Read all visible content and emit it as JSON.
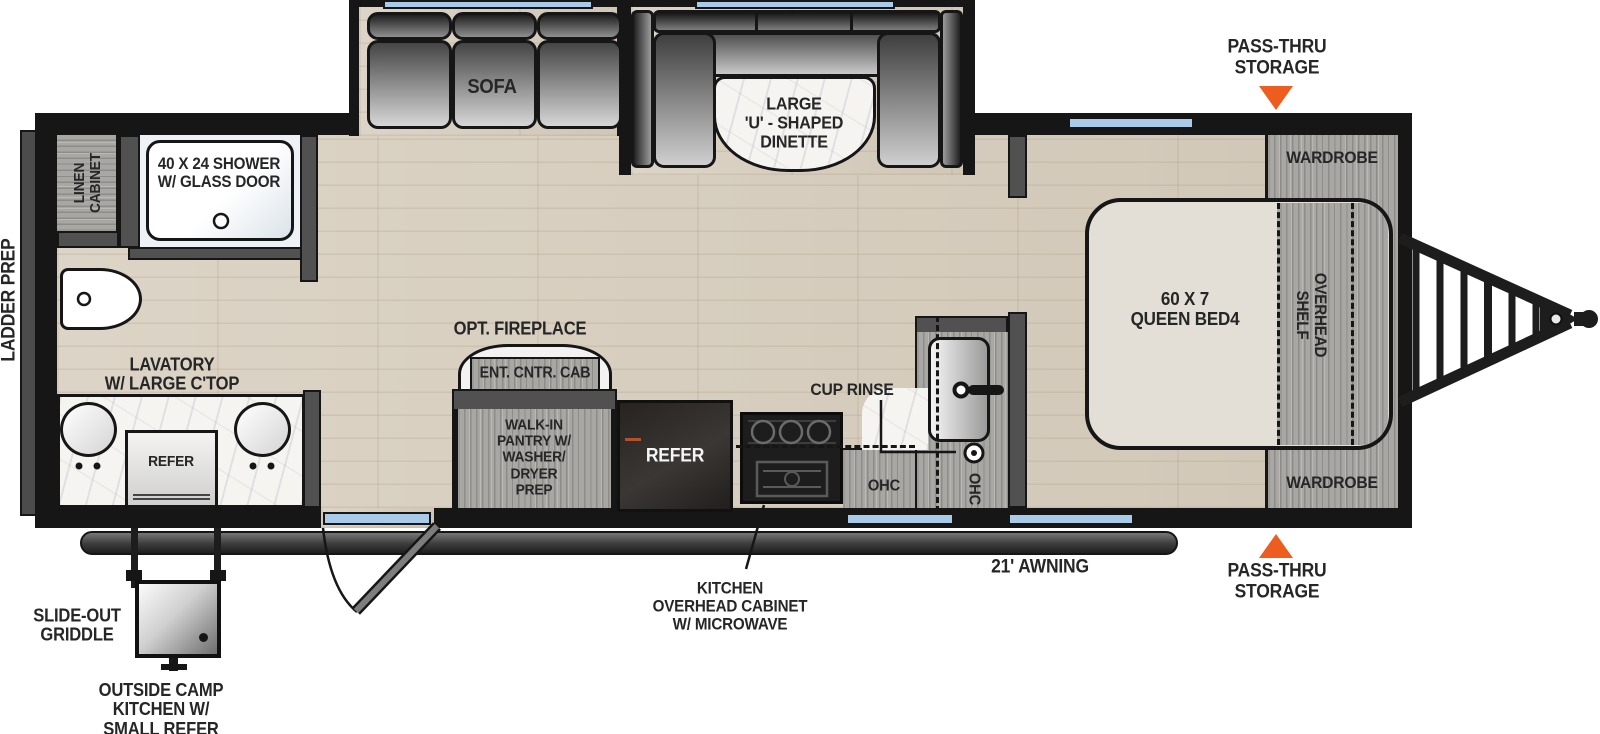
{
  "colors": {
    "accent_orange": "#ee5d20",
    "window_blue": "#a9cbe9",
    "wall": "#161616"
  },
  "exterior": {
    "pass_thru_top": "PASS-THRU\nSTORAGE",
    "pass_thru_bottom": "PASS-THRU\nSTORAGE",
    "ladder_prep": "LADDER PREP",
    "awning": "21' AWNING",
    "slide_out_griddle": "SLIDE-OUT\nGRIDDLE",
    "outside_camp_kitchen": "OUTSIDE CAMP\nKITCHEN W/\nSMALL REFER",
    "kitchen_ohc_callout": "KITCHEN\nOVERHEAD CABINET\nW/ MICROWAVE"
  },
  "bathroom": {
    "linen_cabinet": "LINEN\nCABINET",
    "shower": "40 X 24 SHOWER\nW/ GLASS DOOR",
    "lavatory": "LAVATORY\nW/ LARGE C'TOP",
    "refer": "REFER"
  },
  "living": {
    "sofa": "SOFA",
    "dinette": "LARGE\n'U' - SHAPED\nDINETTE",
    "opt_fireplace": "OPT. FIREPLACE",
    "ent_cntr_cab": "ENT. CNTR. CAB",
    "pantry": "WALK-IN\nPANTRY W/\nWASHER/\nDRYER\nPREP",
    "refer": "REFER"
  },
  "kitchen": {
    "cup_rinse": "CUP RINSE",
    "ohc_1": "OHC",
    "ohc_2": "OHC"
  },
  "bedroom": {
    "queen_bed": "60 X 7\nQUEEN BED4",
    "overhead_shelf": "OVERHEAD\nSHELF",
    "wardrobe_top": "WARDROBE",
    "wardrobe_bottom": "WARDROBE"
  }
}
